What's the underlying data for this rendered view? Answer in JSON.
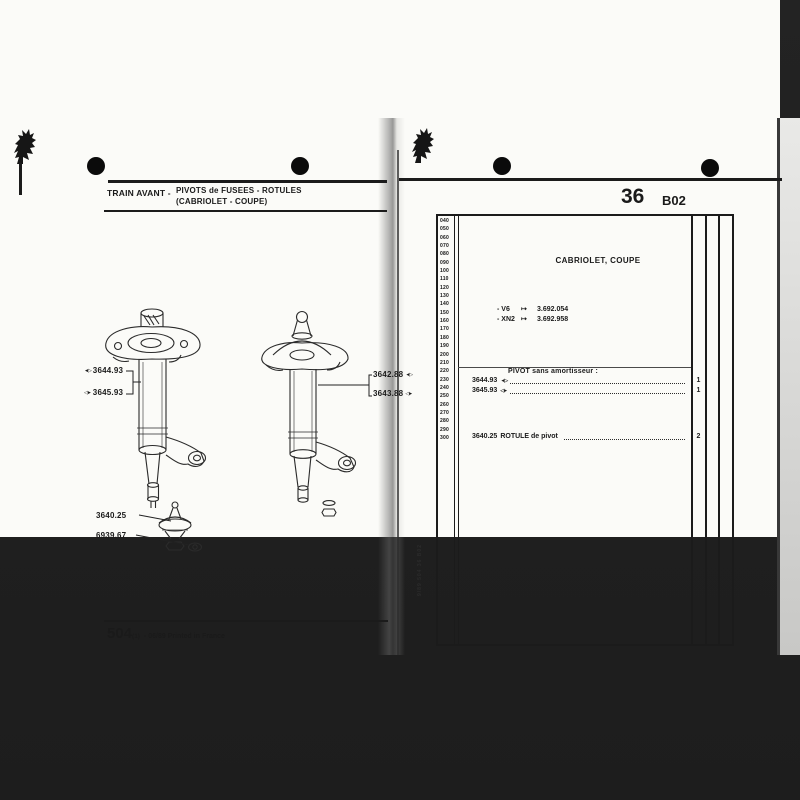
{
  "palette": {
    "paper": "#fbfbf8",
    "ink": "#1b1b1b",
    "photo_background": "#212121"
  },
  "left_page": {
    "header": {
      "section_label": "TRAIN AVANT -",
      "title_line1": "PIVOTS de FUSEES - ROTULES",
      "title_line2": "(CABRIOLET - COUPE)"
    },
    "drawing_labels": {
      "left_strut": [
        {
          "arrow": "◄▷",
          "part": "3644.93"
        },
        {
          "arrow": "◁►",
          "part": "3645.93"
        }
      ],
      "right_strut": [
        {
          "part": "3642.88",
          "arrow": "◄▷"
        },
        {
          "part": "3643.88",
          "arrow": "◁►"
        }
      ],
      "ball_joint": [
        {
          "part": "3640.25"
        },
        {
          "part": "6939.67"
        }
      ]
    },
    "footer": {
      "doc_number": "504",
      "doc_index": "(1)",
      "doc_note": "- 06/89 Printed in France"
    }
  },
  "right_page": {
    "page_code": {
      "chapter": "36",
      "grid": "B02"
    },
    "index_numbers": [
      "040",
      "050",
      "060",
      "070",
      "080",
      "090",
      "100",
      "110",
      "120",
      "130",
      "140",
      "150",
      "160",
      "170",
      "180",
      "190",
      "200",
      "210",
      "220",
      "230",
      "240",
      "250",
      "260",
      "270",
      "280",
      "290",
      "300"
    ],
    "table": {
      "model_heading": "CABRIOLET, COUPE",
      "applicability": [
        {
          "engine": "- V6",
          "arrow": "↦",
          "serial": "3.692.054"
        },
        {
          "engine": "- XN2",
          "arrow": "↦",
          "serial": "3.692.958"
        }
      ],
      "section_heading": "PIVOT sans amortisseur :",
      "pivot_rows": [
        {
          "part": "3644.93",
          "side_arrow": "◄▷",
          "qty": "1"
        },
        {
          "part": "3645.93",
          "side_arrow": "◁►",
          "qty": "1"
        }
      ],
      "rotule_row": {
        "part": "3640.25",
        "description": "ROTULE de pivot",
        "qty": "2"
      }
    },
    "spine_code": "9/89  504  36  B02"
  }
}
